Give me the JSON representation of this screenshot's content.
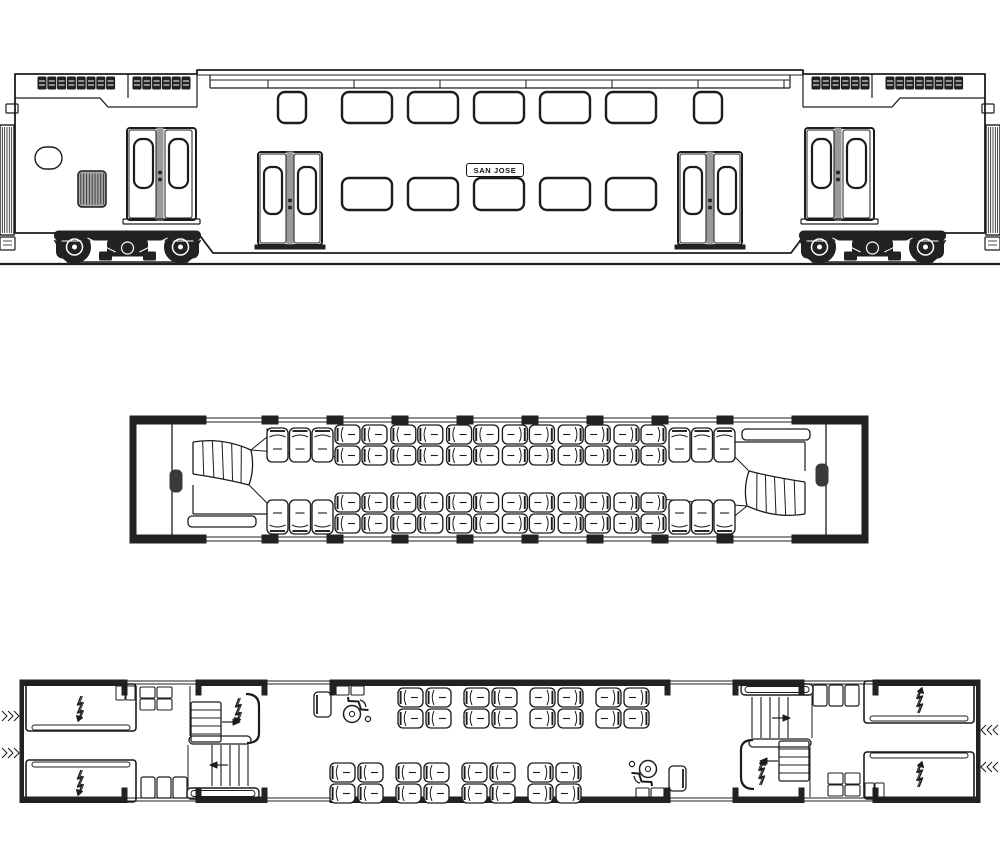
{
  "signboard": {
    "text": "SAN JOSE"
  },
  "colors": {
    "line": "#1c1c1c",
    "dark": "#222222",
    "gray": "#9a9a9a",
    "bg": "#ffffff"
  },
  "icons": {
    "lightning_bolt": "high-voltage-equipment",
    "wheelchair": "accessible-seating",
    "stair_arrow": "stair-direction"
  },
  "elevation": {
    "ground_y": 264,
    "body": {
      "left": 15,
      "right": 985,
      "top_end": 74,
      "top_center": 70,
      "bottom_end": 233,
      "bottom_center": 253,
      "skirt_in": [
        198,
        213
      ],
      "skirt_out": [
        791,
        806
      ]
    },
    "roof": {
      "lines_y": [
        75,
        80,
        88
      ],
      "caps": [
        210,
        790
      ],
      "tick_xs": [
        268,
        354,
        440,
        526,
        612,
        698,
        784
      ]
    },
    "louver_banks": [
      {
        "x": 38,
        "n": 8
      },
      {
        "x": 133,
        "n": 6
      },
      {
        "x": 812,
        "n": 6
      },
      {
        "x": 886,
        "n": 8
      }
    ],
    "louver": {
      "y": 77,
      "w": 8,
      "h": 12,
      "pitch": 9.8
    },
    "step_lines": [
      [
        [
          15,
          98
        ],
        [
          100,
          98
        ],
        [
          108,
          107
        ],
        [
          197,
          107
        ]
      ],
      [
        [
          985,
          98
        ],
        [
          900,
          98
        ],
        [
          892,
          107
        ],
        [
          803,
          107
        ]
      ]
    ],
    "seams": [
      [
        128,
        74,
        98
      ],
      [
        872,
        74,
        98
      ],
      [
        197,
        70,
        107
      ],
      [
        803,
        70,
        107
      ]
    ],
    "diaphragm": {
      "xs": [
        0,
        986
      ],
      "y": 125,
      "w": 14,
      "h": 110
    },
    "notches": [
      [
        6,
        104
      ],
      [
        982,
        104
      ]
    ],
    "coupler_boxes": [
      [
        0,
        237
      ],
      [
        985,
        237
      ]
    ],
    "oval": {
      "x": 35,
      "y": 147,
      "w": 27,
      "h": 22
    },
    "ribbed_box": {
      "x": 78,
      "y": 171,
      "w": 28,
      "h": 36
    },
    "upper_windows": [
      {
        "x": 278,
        "w": 28
      },
      {
        "x": 342,
        "w": 50
      },
      {
        "x": 408,
        "w": 50
      },
      {
        "x": 474,
        "w": 50
      },
      {
        "x": 540,
        "w": 50
      },
      {
        "x": 606,
        "w": 50
      },
      {
        "x": 694,
        "w": 28
      }
    ],
    "upper_window": {
      "y": 92,
      "h": 31
    },
    "lower_windows": [
      342,
      408,
      474,
      540,
      606
    ],
    "lower_window": {
      "y": 178,
      "h": 32,
      "w": 50
    },
    "end_doors": [
      127,
      805
    ],
    "mid_doors": [
      258,
      678
    ],
    "trucks": [
      127.5,
      872.5
    ]
  },
  "upper_plan": {
    "x1": 130,
    "x2": 868,
    "wall_top": 418,
    "wall_bot": 537,
    "end_blocks": [
      [
        130,
        76
      ],
      [
        792,
        76
      ]
    ],
    "mullion_xs": [
      262,
      327,
      392,
      457,
      522,
      587,
      652,
      717
    ],
    "mullion_w": 16,
    "partitions": [
      172,
      826
    ],
    "bench_xs": [
      267,
      669
    ],
    "bench_top_y": 428,
    "bench_bot_y": 500,
    "bench_seat": {
      "w": 21,
      "h": 34
    },
    "unit_xs": [
      335,
      390.8,
      446.6,
      502.4,
      558.2,
      614
    ],
    "rows_top": [
      425,
      446
    ],
    "rows_bot": [
      493,
      514
    ],
    "seat": {
      "w": 25,
      "h": 19,
      "col_gap": 27
    },
    "rot_center": [
      499,
      478
    ]
  },
  "lower_plan": {
    "x1": 20,
    "x2": 980,
    "wall_top": 680,
    "wall_bot": 797,
    "wall_h": 5.5,
    "wall_segs": [
      [
        20,
        127
      ],
      [
        196,
        267
      ],
      [
        330,
        670
      ],
      [
        733,
        804
      ],
      [
        873,
        980
      ]
    ],
    "gaps": [
      [
        127,
        196
      ],
      [
        267,
        330
      ],
      [
        670,
        733
      ],
      [
        804,
        873
      ]
    ],
    "posts": [
      122,
      196,
      262,
      330,
      665,
      733,
      799,
      873
    ],
    "lockers": [
      {
        "x": 26,
        "y": 684,
        "w": 110,
        "h": 47
      },
      {
        "x": 26,
        "y": 760,
        "w": 110,
        "h": 42
      }
    ],
    "locker_bolts": [
      [
        81,
        696
      ],
      [
        81,
        770
      ]
    ],
    "bench_grid": {
      "x": 140,
      "y": 687
    },
    "bench_row": {
      "x": 141,
      "y": 777
    },
    "wheelchair": {
      "seat": [
        314,
        692
      ],
      "boxes": [
        [
          336,
          686
        ],
        [
          351,
          686
        ]
      ],
      "icon": [
        357,
        706
      ]
    },
    "unit_xs_top": [
      398,
      464,
      530,
      596
    ],
    "rows_top": [
      688,
      709
    ],
    "unit_xs_bot": [
      330,
      396,
      462,
      528
    ],
    "rows_bot": [
      763,
      784
    ],
    "seat": {
      "w": 25,
      "h": 19,
      "col_gap": 28
    },
    "rot_center": [
      500,
      741.5
    ]
  }
}
